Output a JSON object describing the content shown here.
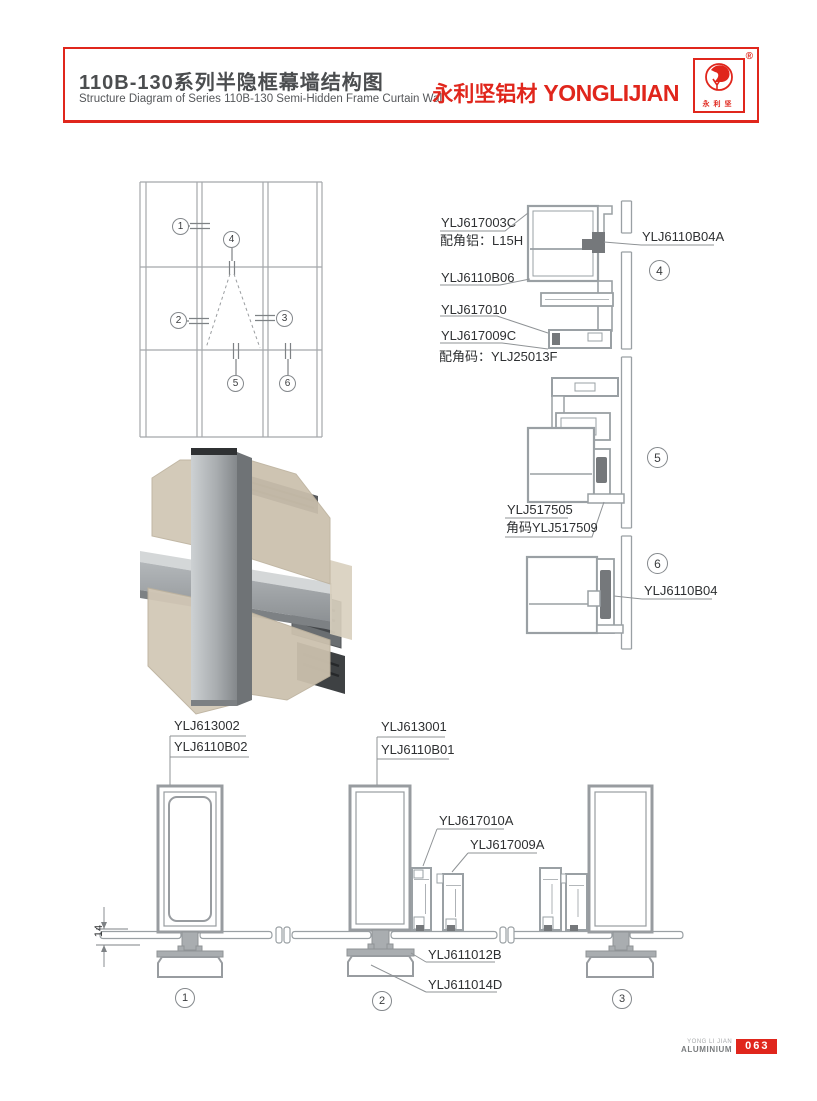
{
  "header": {
    "title_cn": "110B-130系列半隐框幕墙结构图",
    "title_en": "Structure Diagram of Series 110B-130 Semi-Hidden Frame Curtain Wall",
    "brand_cn": "永利坚铝材",
    "brand_en": "YONGLIJIAN",
    "registered_mark": "®",
    "logo_chars": "永利坚",
    "accent_color": "#e0261c"
  },
  "schematic": {
    "callouts": [
      "1",
      "2",
      "3",
      "4",
      "5",
      "6"
    ]
  },
  "details_right": {
    "section4": {
      "callout": "4",
      "labels": {
        "l1": "YLJ617003C",
        "l2": "配角铝：L15H",
        "l3": "YLJ6110B06",
        "l4": "YLJ617010",
        "l5": "YLJ617009C",
        "l6": "配角码：YLJ25013F",
        "r1": "YLJ6110B04A"
      }
    },
    "section5": {
      "callout": "5",
      "labels": {
        "l1": "YLJ517505",
        "l2": "角码YLJ517509"
      }
    },
    "section6": {
      "callout": "6",
      "labels": {
        "r1": "YLJ6110B04"
      }
    }
  },
  "details_bottom": {
    "section1": {
      "callout": "1",
      "dimension": "14",
      "labels": {
        "t1": "YLJ613002",
        "t2": "YLJ6110B02"
      }
    },
    "section2": {
      "callout": "2",
      "labels": {
        "t1": "YLJ613001",
        "t2": "YLJ6110B01",
        "m1": "YLJ617010A",
        "m2": "YLJ617009A",
        "b1": "YLJ611012B",
        "b2": "YLJ611014D"
      }
    },
    "section3": {
      "callout": "3"
    }
  },
  "footer": {
    "brand_line1": "YONG LI JIAN",
    "brand_line2": "ALUMINIUM",
    "page_number": "063"
  }
}
